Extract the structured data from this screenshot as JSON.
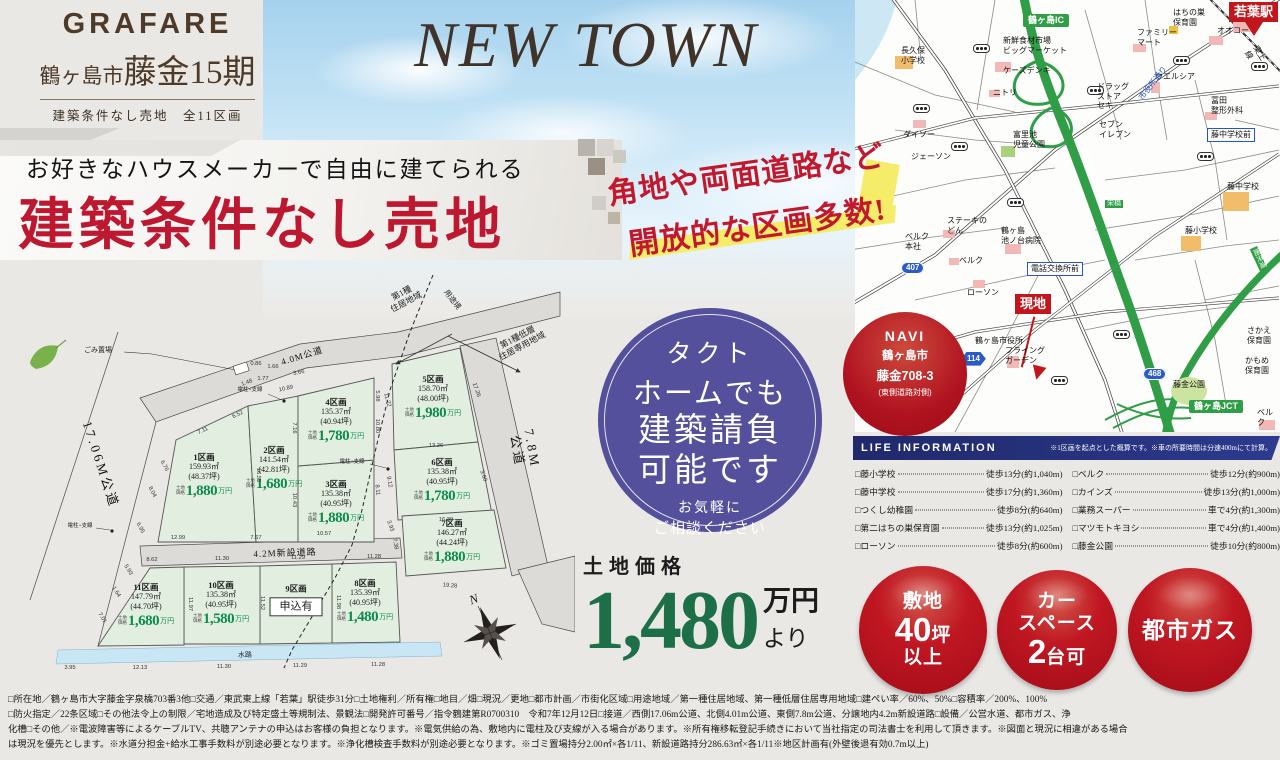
{
  "header": {
    "brand": "GRAFARE",
    "city": "鶴ヶ島市",
    "project": "藤金15期",
    "subtitle": "建築条件なし売地　全11区画",
    "newtown": "NEW TOWN"
  },
  "banner": {
    "catch": "お好きなハウスメーカーで自由に建てられる",
    "title": "建築条件なし売地",
    "side1": "角地や両面道路など",
    "side2": "開放的な区画多数!"
  },
  "tact": {
    "line1": "タクト",
    "line2": "ホームでも",
    "line3": "建築請負",
    "line4": "可能です",
    "sub1": "お気軽に",
    "sub2": "ご相談ください"
  },
  "price": {
    "label": "土地価格",
    "amount": "1,480",
    "unit": "万円",
    "suffix": "より"
  },
  "badges": {
    "items": [
      {
        "lines": [
          "敷地",
          "40坪",
          "以上"
        ]
      },
      {
        "lines": [
          "カー",
          "スペース",
          "2台可"
        ]
      },
      {
        "lines": [
          "都市ガス"
        ]
      }
    ]
  },
  "colors": {
    "accent_red": "#bd1830",
    "price_green": "#0f8c4d",
    "navy": "#1f296b",
    "purple": "#54509c",
    "map_green": "#2f9e46"
  },
  "site_plan": {
    "price_prefix": "土地\n価格",
    "price_unit": "万円",
    "lots": [
      {
        "no": "1区画",
        "area": "159.93㎡",
        "tsubo": "(48.37坪)",
        "price": "1,880"
      },
      {
        "no": "2区画",
        "area": "141.54㎡",
        "tsubo": "(42.81坪)",
        "price": "1,680"
      },
      {
        "no": "3区画",
        "area": "135.38㎡",
        "tsubo": "(40.95坪)",
        "price": "1,880"
      },
      {
        "no": "4区画",
        "area": "135.37㎡",
        "tsubo": "(40.94坪)",
        "price": "1,780"
      },
      {
        "no": "5区画",
        "area": "158.70㎡",
        "tsubo": "(48.00坪)",
        "price": "1,980"
      },
      {
        "no": "6区画",
        "area": "135.38㎡",
        "tsubo": "(40.95坪)",
        "price": "1,780"
      },
      {
        "no": "7区画",
        "area": "146.27㎡",
        "tsubo": "(44.24坪)",
        "price": "1,880"
      },
      {
        "no": "8区画",
        "area": "135.39㎡",
        "tsubo": "(40.95坪)",
        "price": "1,480"
      },
      {
        "no": "9区画",
        "status": "申込有"
      },
      {
        "no": "10区画",
        "area": "135.38㎡",
        "tsubo": "(40.95坪)",
        "price": "1,580"
      },
      {
        "no": "11区画",
        "area": "147.79㎡",
        "tsubo": "(44.70坪)",
        "price": "1,680"
      }
    ],
    "labels": [
      {
        "t": "17.06M公道",
        "x": 100,
        "y": 195,
        "r": 72,
        "cls": "road-name big"
      },
      {
        "t": "4.0M公道",
        "x": 302,
        "y": 86,
        "r": -17,
        "cls": "road-name"
      },
      {
        "t": "7.8M公道",
        "x": 524,
        "y": 180,
        "r": 80,
        "cls": "road-name big"
      },
      {
        "t": "4.2M新設道路",
        "x": 285,
        "y": 283,
        "r": -2,
        "cls": "road-name"
      },
      {
        "t": "水路",
        "x": 245,
        "y": 385,
        "r": -1,
        "cls": "tiny"
      },
      {
        "t": "第1種\n住居地域",
        "x": 404,
        "y": 28,
        "r": -28,
        "cls": "zone"
      },
      {
        "t": "用途境",
        "x": 452,
        "y": 30,
        "r": 52,
        "cls": "small"
      },
      {
        "t": "第1種低層\n住居専用地域",
        "x": 520,
        "y": 72,
        "r": -28,
        "cls": "zone"
      },
      {
        "t": "ごみ置場",
        "x": 98,
        "y": 80,
        "r": 0,
        "cls": "tiny"
      },
      {
        "t": "電柱+支線",
        "x": 250,
        "y": 120,
        "r": 0,
        "cls": "micro"
      },
      {
        "t": "電柱+支線",
        "x": 352,
        "y": 192,
        "r": 0,
        "cls": "micro"
      },
      {
        "t": "電柱+支線",
        "x": 80,
        "y": 256,
        "r": 0,
        "cls": "micro"
      },
      {
        "t": "N",
        "x": 474,
        "y": 330,
        "r": -20,
        "cls": "compass-n"
      }
    ],
    "dimensions": [
      {
        "t": "0.86",
        "x": 256,
        "y": 94,
        "r": 0
      },
      {
        "t": "1.66",
        "x": 273,
        "y": 97,
        "r": 0
      },
      {
        "t": "1.77",
        "x": 263,
        "y": 109,
        "r": 0
      },
      {
        "t": "1.48",
        "x": 247,
        "y": 113,
        "r": -20
      },
      {
        "t": "6.52",
        "x": 238,
        "y": 145,
        "r": -25
      },
      {
        "t": "7.11",
        "x": 203,
        "y": 161,
        "r": -25
      },
      {
        "t": "3.66",
        "x": 299,
        "y": 103,
        "r": -12
      },
      {
        "t": "10.89",
        "x": 286,
        "y": 119,
        "r": -12
      },
      {
        "t": "16.55",
        "x": 258,
        "y": 205,
        "r": 90
      },
      {
        "t": "7.16",
        "x": 294,
        "y": 158,
        "r": 90
      },
      {
        "t": "10.43",
        "x": 294,
        "y": 230,
        "r": 90
      },
      {
        "t": "5.98",
        "x": 377,
        "y": 126,
        "r": 90
      },
      {
        "t": "10.80",
        "x": 377,
        "y": 156,
        "r": 90
      },
      {
        "t": "11.72",
        "x": 387,
        "y": 130,
        "r": 75
      },
      {
        "t": "9.12",
        "x": 389,
        "y": 212,
        "r": 80
      },
      {
        "t": "7.38",
        "x": 395,
        "y": 274,
        "r": 80
      },
      {
        "t": "8.11",
        "x": 377,
        "y": 220,
        "r": 85
      },
      {
        "t": "17.26",
        "x": 476,
        "y": 120,
        "r": 70
      },
      {
        "t": "3.60",
        "x": 483,
        "y": 206,
        "r": 70
      },
      {
        "t": "13.26",
        "x": 436,
        "y": 176,
        "r": 0
      },
      {
        "t": "16.39",
        "x": 446,
        "y": 250,
        "r": 0
      },
      {
        "t": "19.28",
        "x": 450,
        "y": 316,
        "r": 5
      },
      {
        "t": "12.99",
        "x": 178,
        "y": 268,
        "r": 0
      },
      {
        "t": "7.67",
        "x": 256,
        "y": 268,
        "r": 0
      },
      {
        "t": "10.57",
        "x": 324,
        "y": 264,
        "r": 0
      },
      {
        "t": "3.93",
        "x": 390,
        "y": 256,
        "r": 70
      },
      {
        "t": "8.62",
        "x": 152,
        "y": 290,
        "r": 0
      },
      {
        "t": "11.30",
        "x": 222,
        "y": 289,
        "r": 0
      },
      {
        "t": "11.29",
        "x": 298,
        "y": 288,
        "r": 0
      },
      {
        "t": "11.28",
        "x": 374,
        "y": 287,
        "r": 0
      },
      {
        "t": "11.97",
        "x": 190,
        "y": 334,
        "r": 90
      },
      {
        "t": "11.52",
        "x": 262,
        "y": 333,
        "r": 90
      },
      {
        "t": "11.98",
        "x": 338,
        "y": 332,
        "r": 90
      },
      {
        "t": "3.95",
        "x": 70,
        "y": 398,
        "r": 0
      },
      {
        "t": "12.13",
        "x": 140,
        "y": 398,
        "r": 0
      },
      {
        "t": "11.30",
        "x": 224,
        "y": 397,
        "r": 0
      },
      {
        "t": "11.29",
        "x": 300,
        "y": 396,
        "r": 0
      },
      {
        "t": "11.28",
        "x": 378,
        "y": 395,
        "r": 0
      },
      {
        "t": "8.04",
        "x": 152,
        "y": 222,
        "r": 62
      },
      {
        "t": "6.76",
        "x": 164,
        "y": 196,
        "r": 62
      },
      {
        "t": "6.95",
        "x": 140,
        "y": 258,
        "r": 62
      },
      {
        "t": "5.93",
        "x": 128,
        "y": 300,
        "r": 58
      },
      {
        "t": "1.64",
        "x": 116,
        "y": 322,
        "r": 58
      },
      {
        "t": "7.01",
        "x": 102,
        "y": 348,
        "r": 58
      }
    ]
  },
  "navi": {
    "title": "NAVI",
    "line1": "鶴ヶ島市",
    "line2": "藤金708-3",
    "line3": "(東側道路対側)"
  },
  "map": {
    "items": [
      {
        "t": "鶴ヶ島IC",
        "x": 168,
        "y": 14,
        "type": "badge-green"
      },
      {
        "t": "新鮮食材市場\nビッグマーケット",
        "x": 148,
        "y": 36,
        "type": "label"
      },
      {
        "t": "ケーズデンキ",
        "x": 148,
        "y": 66,
        "type": "label"
      },
      {
        "t": "ニトリ",
        "x": 138,
        "y": 88,
        "type": "label"
      },
      {
        "t": "長久保\n小学校",
        "x": 46,
        "y": 46,
        "type": "label"
      },
      {
        "t": "ダイソー",
        "x": 48,
        "y": 130,
        "type": "label"
      },
      {
        "t": "ジェーソン",
        "x": 56,
        "y": 152,
        "type": "label"
      },
      {
        "t": "ステーキの\nどん",
        "x": 92,
        "y": 216,
        "type": "label"
      },
      {
        "t": "ベルク\n本社",
        "x": 50,
        "y": 232,
        "type": "label"
      },
      {
        "t": "ベルク",
        "x": 104,
        "y": 256,
        "type": "label"
      },
      {
        "t": "ローソン",
        "x": 112,
        "y": 288,
        "type": "label"
      },
      {
        "t": "鶴ヶ島\n池ノ台病院",
        "x": 146,
        "y": 226,
        "type": "label"
      },
      {
        "t": "電話交換所前",
        "x": 172,
        "y": 262,
        "type": "box-blue"
      },
      {
        "t": "富里池\n児童公園",
        "x": 158,
        "y": 130,
        "type": "label"
      },
      {
        "t": "鶴ヶ島市役所",
        "x": 120,
        "y": 336,
        "type": "label"
      },
      {
        "t": "フライング\nガーデン",
        "x": 150,
        "y": 346,
        "type": "label"
      },
      {
        "t": "現地",
        "x": 160,
        "y": 294,
        "type": "badge-red-big"
      },
      {
        "t": "ドラッグ\nストア\nセキ",
        "x": 242,
        "y": 82,
        "type": "label"
      },
      {
        "t": "セブン\nイレブン",
        "x": 244,
        "y": 120,
        "type": "label"
      },
      {
        "t": "ウエルシア",
        "x": 300,
        "y": 72,
        "type": "label"
      },
      {
        "t": "市役所通り",
        "x": 282,
        "y": 96,
        "type": "label-blue",
        "r": -52
      },
      {
        "t": "ファミリー\nマート",
        "x": 282,
        "y": 28,
        "type": "label"
      },
      {
        "t": "はちの巣\n保育園",
        "x": 318,
        "y": 8,
        "type": "label"
      },
      {
        "t": "オオコー",
        "x": 362,
        "y": 26,
        "type": "label"
      },
      {
        "t": "若葉駅",
        "x": 374,
        "y": 2,
        "type": "badge-red-big"
      },
      {
        "t": "東上線",
        "x": 404,
        "y": 44,
        "type": "label",
        "r": 58
      },
      {
        "t": "冨田\n整形外科",
        "x": 356,
        "y": 96,
        "type": "label"
      },
      {
        "t": "藤中学校前",
        "x": 352,
        "y": 128,
        "type": "box-blue"
      },
      {
        "t": "藤中学校",
        "x": 372,
        "y": 182,
        "type": "label"
      },
      {
        "t": "藤小学校",
        "x": 330,
        "y": 226,
        "type": "label"
      },
      {
        "t": "関越自動車道",
        "x": 232,
        "y": 146,
        "type": "road-label",
        "r": 70
      },
      {
        "t": "栄橋",
        "x": 250,
        "y": 200,
        "type": "road-label-sm"
      },
      {
        "t": "圏央道",
        "x": 402,
        "y": 246,
        "type": "road-label-sm",
        "r": 65
      },
      {
        "t": "468",
        "x": 288,
        "y": 368,
        "type": "shield"
      },
      {
        "t": "407",
        "x": 46,
        "y": 262,
        "type": "shield"
      },
      {
        "t": "114",
        "x": 106,
        "y": 352,
        "type": "shield-hex"
      },
      {
        "t": "藤金公園",
        "x": 318,
        "y": 380,
        "type": "label"
      },
      {
        "t": "鶴ヶ島JCT",
        "x": 334,
        "y": 400,
        "type": "badge-green"
      },
      {
        "t": "さかえ\n保育園",
        "x": 392,
        "y": 326,
        "type": "label"
      },
      {
        "t": "かもめ\n保育園",
        "x": 390,
        "y": 356,
        "type": "label"
      },
      {
        "t": "ベルク",
        "x": 402,
        "y": 408,
        "type": "label"
      }
    ]
  },
  "life": {
    "title": "LIFE INFORMATION",
    "note": "※1区画を起点とした概算です。※車の所要時間は分速400mにて計算。",
    "items_left": [
      {
        "name": "藤小学校",
        "value": "徒歩13分(約1,040m)"
      },
      {
        "name": "藤中学校",
        "value": "徒歩17分(約1,360m)"
      },
      {
        "name": "つくし幼稚園",
        "value": "徒歩8分(約640m)"
      },
      {
        "name": "第二はちの巣保育園",
        "value": "徒歩13分(約1,025m)"
      },
      {
        "name": "ローソン",
        "value": "徒歩8分(約600m)"
      }
    ],
    "items_right": [
      {
        "name": "ベルク",
        "value": "徒歩12分(約900m)"
      },
      {
        "name": "カインズ",
        "value": "徒歩13分(約1,000m)"
      },
      {
        "name": "業務スーパー",
        "value": "車で4分(約1,300m)"
      },
      {
        "name": "マツモトキヨシ",
        "value": "車で4分(約1,400m)"
      },
      {
        "name": "藤金公園",
        "value": "徒歩10分(約800m)"
      }
    ]
  },
  "legal": {
    "lines": [
      "□所在地／鶴ヶ島市大字藤金字泉橋703番3他□交通／東武東上線「若葉」駅徒歩31分□土地権利／所有権□地目／畑□現況／更地□都市計画／市街化区域□用途地域／第一種住居地域、第一種低層住居専用地域□建ぺい率／60%、50%□容積率／200%、100%",
      "□防火指定／22条区域□その他法令上の制限／宅地造成及び特定盛土等規制法、景観法□開発許可番号／指令鶴建第R0700310　令和7年12月12日□接道／西側17.06m公道、北側4.01m公道、東側7.8m公道、分譲地内4.2m新設道路□設備／公営水道、都市ガス、浄",
      "化槽□その他／※電波障害等によるケーブルTV、共聴アンテナの申込はお客様の負担となります。※電気供給の為、敷地内に電柱及び支線が入る場合があります。※所有権移転登記手続きにおいて当社指定の司法書士を利用して頂きます。※図面と現況に相違がある場合",
      "は現況を優先とします。※水道分担金+給水工事手数料が別途必要となります。※浄化槽検査手数料が別途必要となります。※ゴミ置場持分2.00㎡×各1/11、新設道路持分286.63㎡×各1/11※地区計画有(外壁後退有効0.7m以上)"
    ]
  }
}
